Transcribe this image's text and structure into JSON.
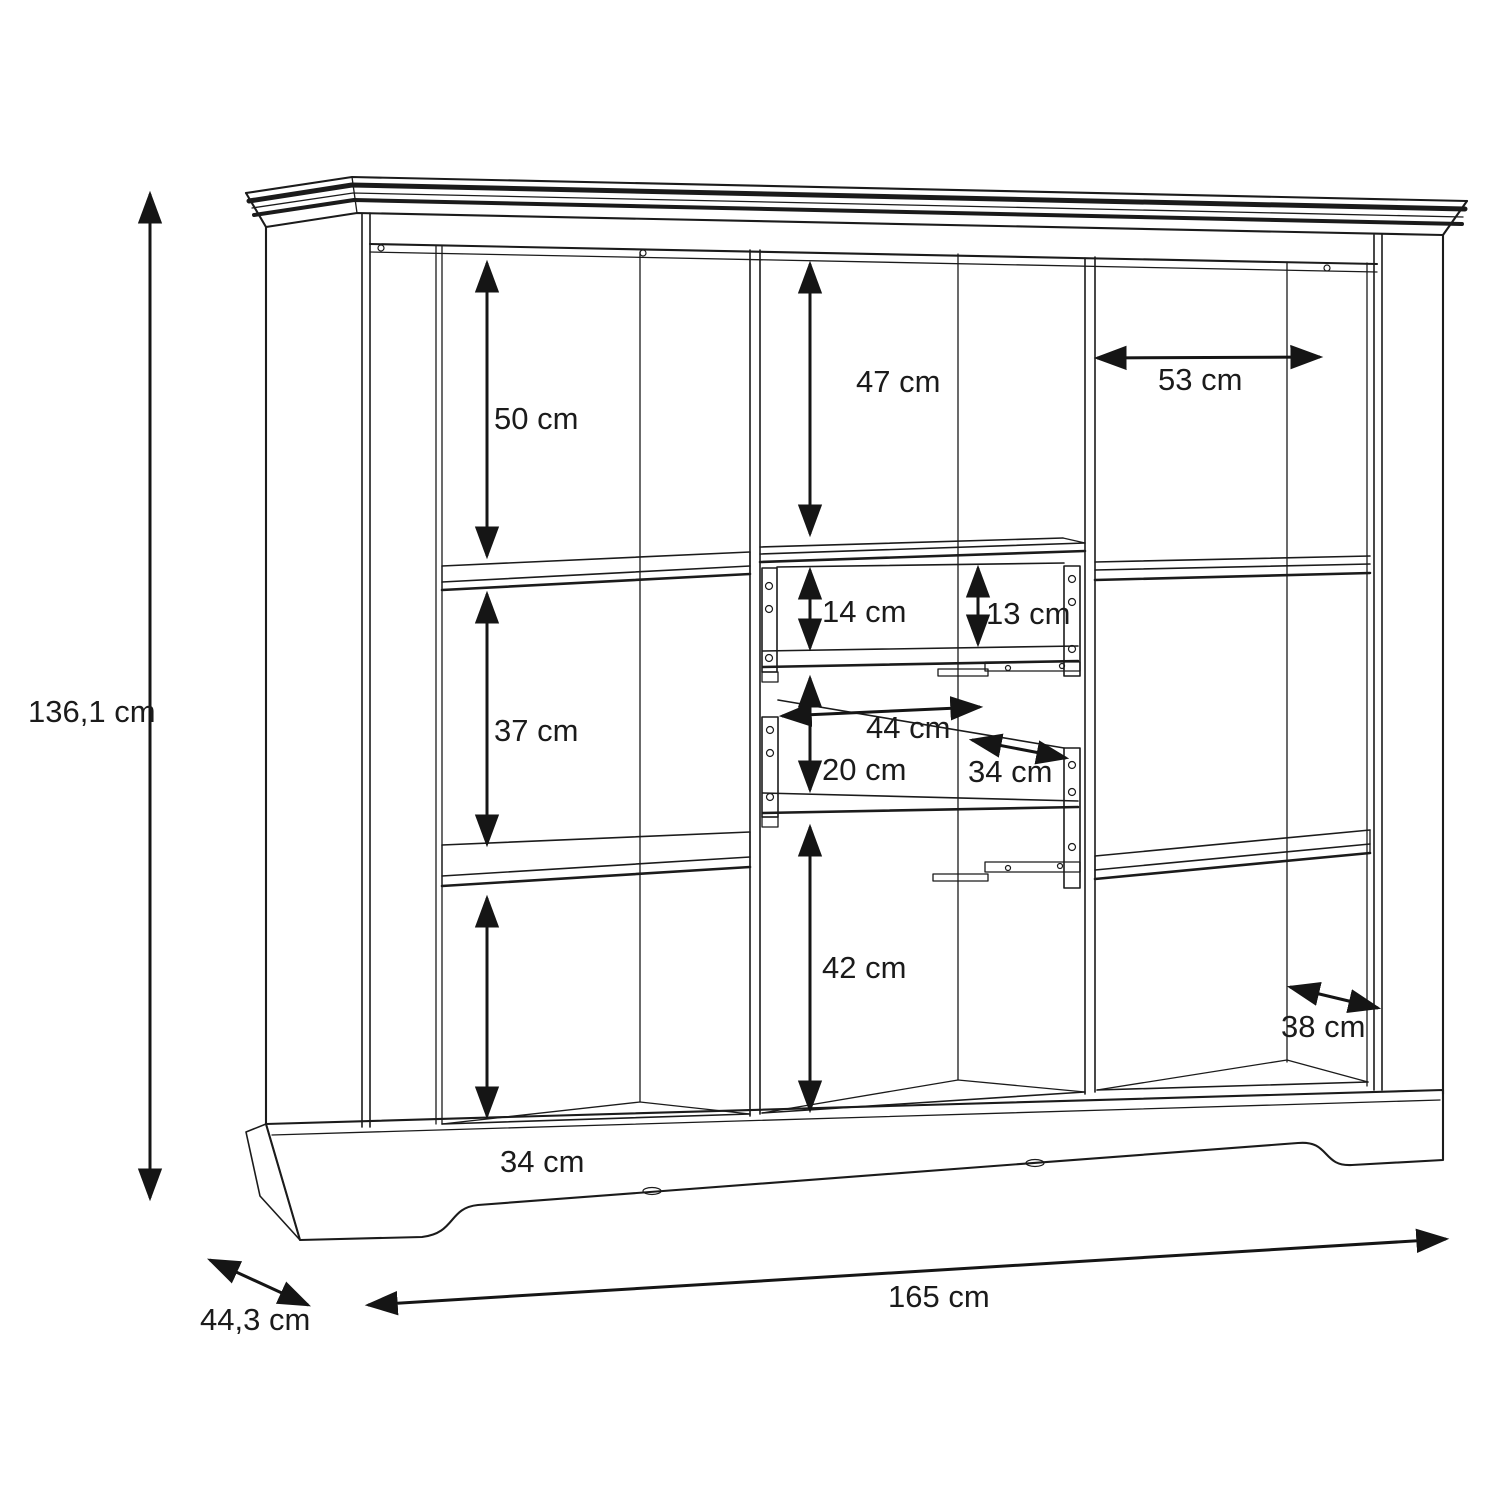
{
  "figure": {
    "kind": "furniture dimension diagram (highboard line drawing)",
    "unit": "cm",
    "line_color": "#1b1b1b",
    "background": "#ffffff"
  },
  "overall": {
    "height": {
      "label": "136,1 cm",
      "value": 136.1
    },
    "width": {
      "label": "165 cm",
      "value": 165
    },
    "depth": {
      "label": "44,3 cm",
      "value": 44.3
    }
  },
  "left_column": {
    "top": {
      "label": "50 cm",
      "value": 50
    },
    "middle": {
      "label": "37 cm",
      "value": 37
    },
    "bottom": {
      "label": "34 cm",
      "value": 34
    }
  },
  "center_column": {
    "top": {
      "label": "47 cm",
      "value": 47
    },
    "drawer_upper_front": {
      "label": "14 cm",
      "value": 14
    },
    "drawer_upper_clear": {
      "label": "13 cm",
      "value": 13
    },
    "drawer_lower_width": {
      "label": "44 cm",
      "value": 44
    },
    "drawer_lower_front": {
      "label": "20 cm",
      "value": 20
    },
    "drawer_lower_depth": {
      "label": "34 cm",
      "value": 34
    },
    "bottom": {
      "label": "42 cm",
      "value": 42
    }
  },
  "right_column": {
    "width": {
      "label": "53 cm",
      "value": 53
    },
    "depth": {
      "label": "38 cm",
      "value": 38
    }
  }
}
